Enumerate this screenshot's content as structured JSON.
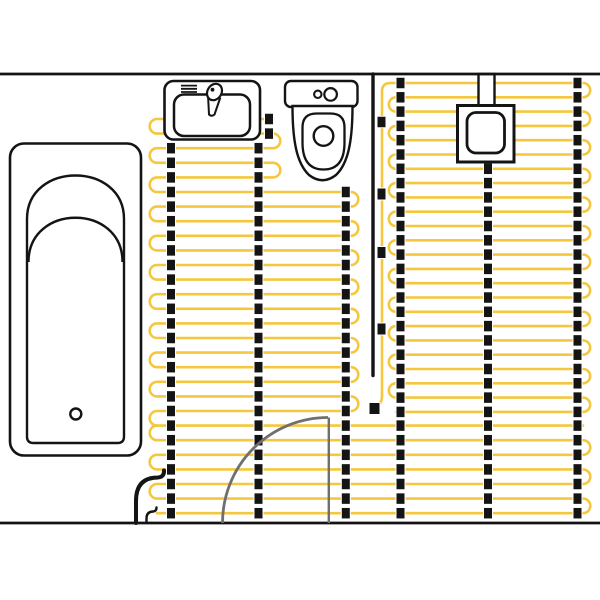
{
  "meta": {
    "title": "bathroom-underfloor-heating-plan",
    "canvas": {
      "width": 600,
      "height": 600
    }
  },
  "colors": {
    "cable_yellow": "#F4C73E",
    "ink_black": "#141414",
    "door_gray": "#6f6f6f",
    "background": "#ffffff"
  },
  "walls": {
    "top": {
      "d": "M0,74 H600",
      "sw": 2.7
    },
    "bottom": {
      "d": "M0,523 H600",
      "sw": 2.7
    }
  },
  "mats": [
    {
      "name": "middle-mat",
      "start": "R",
      "y0": 119,
      "dy": 14.6,
      "bands": [
        {
          "n": 5,
          "x1": 157,
          "x2": 273
        },
        {
          "n": 16,
          "x1": 157,
          "x2": 351
        }
      ],
      "suffix": "A7.3,7.3 0 0 0 157,425.6"
    },
    {
      "name": "right-mat",
      "start": "L",
      "y0": 83,
      "dy": 14.3,
      "prefix": "M375.5,406.5 Q382,404 382,396 L382,91.5 Q382,83 390.5,83",
      "bands": [
        {
          "n": 24,
          "x1": 396,
          "x2": 583
        }
      ]
    },
    {
      "name": "bottom-mat",
      "start": "R",
      "y0": 425.6,
      "dy": 14.6,
      "bands": [
        {
          "n": 7,
          "x1": 157,
          "x2": 583
        }
      ]
    }
  ],
  "cable_stroke": 2.6,
  "strips": [
    {
      "x": 171,
      "min": 146,
      "max": 520
    },
    {
      "x": 258.5,
      "min": 146,
      "max": 520
    },
    {
      "x": 269,
      "min": 112,
      "max": 145
    },
    {
      "x": 345.8,
      "min": 185,
      "max": 520
    },
    {
      "x": 400.5,
      "min": 80,
      "max": 520
    },
    {
      "x": 488,
      "min": 165,
      "max": 520
    },
    {
      "x": 577.5,
      "min": 80,
      "max": 520
    }
  ],
  "clip_size": {
    "w": 9,
    "h": 11.5
  },
  "feed_clips": [
    {
      "x": 381.5,
      "y": 122,
      "w": 9,
      "h": 11.5
    },
    {
      "x": 381.5,
      "y": 194,
      "w": 9,
      "h": 12
    },
    {
      "x": 381.5,
      "y": 252.5,
      "w": 9,
      "h": 12
    },
    {
      "x": 381.5,
      "y": 329,
      "w": 9,
      "h": 12
    },
    {
      "x": 374.5,
      "y": 408.5,
      "w": 11,
      "h": 12
    }
  ],
  "sensor_line": {
    "d": "M373,74 L373,375.5",
    "sw": 3.4
  },
  "exit_cables": [
    {
      "name": "power-lead-thick",
      "d": "M136,523 L136,501 Q136,477.5 158,477.5 Q164.5,477 164,470.5",
      "sw": 4
    },
    {
      "name": "power-lead-thin",
      "d": "M146.5,523 L146.5,518.5 Q146.5,511.5 153.5,511.5 Q156.5,511 156.5,507.5",
      "sw": 2.4
    }
  ],
  "door": {
    "arc": {
      "d": "M222.5,523 A105.5,105.5 0 0 1 328,417.5",
      "sw": 2.8
    },
    "leaf": {
      "d": "M328.8,417.5 L328.8,523",
      "sw": 2.4
    }
  },
  "fixtures": {
    "bathtub": [
      {
        "type": "rect",
        "x": 10,
        "y": 143.5,
        "w": 131,
        "h": 312,
        "rx": 14,
        "sw": 2.6,
        "fill": "#fff",
        "name": "bathtub-rim"
      },
      {
        "type": "path",
        "d": "M27,219 C27,161 124,161 124,219 L124,436.5 Q124,443 117.5,443 L33.5,443 Q27,443 27,436.5 Z",
        "sw": 2.4,
        "fill": "#fff",
        "name": "bathtub-basin"
      },
      {
        "type": "path",
        "d": "M28.5,262 C28.5,203 122.5,203 122.5,262",
        "sw": 2.4,
        "fill": "none",
        "name": "bathtub-slope-line"
      },
      {
        "type": "circle",
        "cx": 75.8,
        "cy": 414,
        "r": 5.5,
        "sw": 2.4,
        "fill": "#fff",
        "name": "bathtub-drain"
      }
    ],
    "sink": [
      {
        "type": "rect",
        "x": 164.5,
        "y": 81,
        "w": 95.5,
        "h": 58.5,
        "rx": 9,
        "sw": 2.6,
        "fill": "#fff",
        "name": "sink-counter"
      },
      {
        "type": "rect",
        "x": 174,
        "y": 94.5,
        "w": 76,
        "h": 41.5,
        "rx": 10,
        "sw": 2.5,
        "fill": "#fff",
        "name": "sink-basin"
      },
      {
        "type": "path",
        "d": "M181,85.6 H197 M181,88.8 H197 M181,92 H197",
        "sw": 1.8,
        "fill": "none",
        "name": "sink-vent-lines"
      },
      {
        "type": "path",
        "d": "M208,95 L220,98.5 L214.5,114.5 Q211.5,117 209,114.5 Z",
        "sw": 2,
        "fill": "#fff",
        "name": "faucet-handle"
      },
      {
        "type": "ellipse",
        "cx": 214.5,
        "cy": 92,
        "rx": 7,
        "ry": 8.6,
        "rot": 32,
        "sw": 2.2,
        "fill": "#fff",
        "name": "faucet-head"
      },
      {
        "type": "circle",
        "cx": 212.5,
        "cy": 89.7,
        "r": 1.9,
        "sw": 0,
        "fill": "#141414",
        "name": "faucet-dot"
      }
    ],
    "toilet": [
      {
        "type": "rect",
        "x": 285,
        "y": 81,
        "w": 72.5,
        "h": 26,
        "rx": 6,
        "sw": 2.4,
        "fill": "#fff",
        "name": "toilet-tank"
      },
      {
        "type": "path",
        "d": "M292.5,106 C292.5,142 297,163.5 309,175 Q322.5,185.5 336,175 C348,163.5 352.5,142 352.5,106 Z",
        "sw": 2.4,
        "fill": "#fff",
        "name": "toilet-bowl"
      },
      {
        "type": "path",
        "d": "M302.5,127.5 Q302.5,113.5 316.5,113.5 L330.5,113.5 Q344.5,113.5 344.5,127.5 L344.5,142.5 Q344.5,169.5 323.5,169.5 Q302.5,169.5 302.5,142.5 Z",
        "sw": 2.3,
        "fill": "#fff",
        "name": "toilet-seat"
      },
      {
        "type": "circle",
        "cx": 317.8,
        "cy": 94.3,
        "r": 3.7,
        "sw": 2.1,
        "fill": "#fff",
        "name": "toilet-button-small"
      },
      {
        "type": "circle",
        "cx": 330.6,
        "cy": 94.4,
        "r": 6.3,
        "sw": 2.2,
        "fill": "#fff",
        "name": "toilet-button-large"
      },
      {
        "type": "circle",
        "cx": 323.5,
        "cy": 136,
        "r": 9.8,
        "sw": 2.4,
        "fill": "#fff",
        "name": "toilet-flush-hole"
      }
    ],
    "thermostat": [
      {
        "type": "rect",
        "x": 478.5,
        "y": 74,
        "w": 16,
        "h": 33,
        "rx": 0,
        "sw": 2.4,
        "fill": "#fff",
        "name": "thermostat-conduit"
      },
      {
        "type": "rect",
        "x": 457.5,
        "y": 105.5,
        "w": 56.5,
        "h": 56.5,
        "rx": 0,
        "sw": 3,
        "fill": "#fff",
        "name": "thermostat-box"
      },
      {
        "type": "rect",
        "x": 467,
        "y": 112.5,
        "w": 37.5,
        "h": 40.5,
        "rx": 9,
        "sw": 2.8,
        "fill": "#fff",
        "name": "thermostat-display"
      }
    ]
  }
}
